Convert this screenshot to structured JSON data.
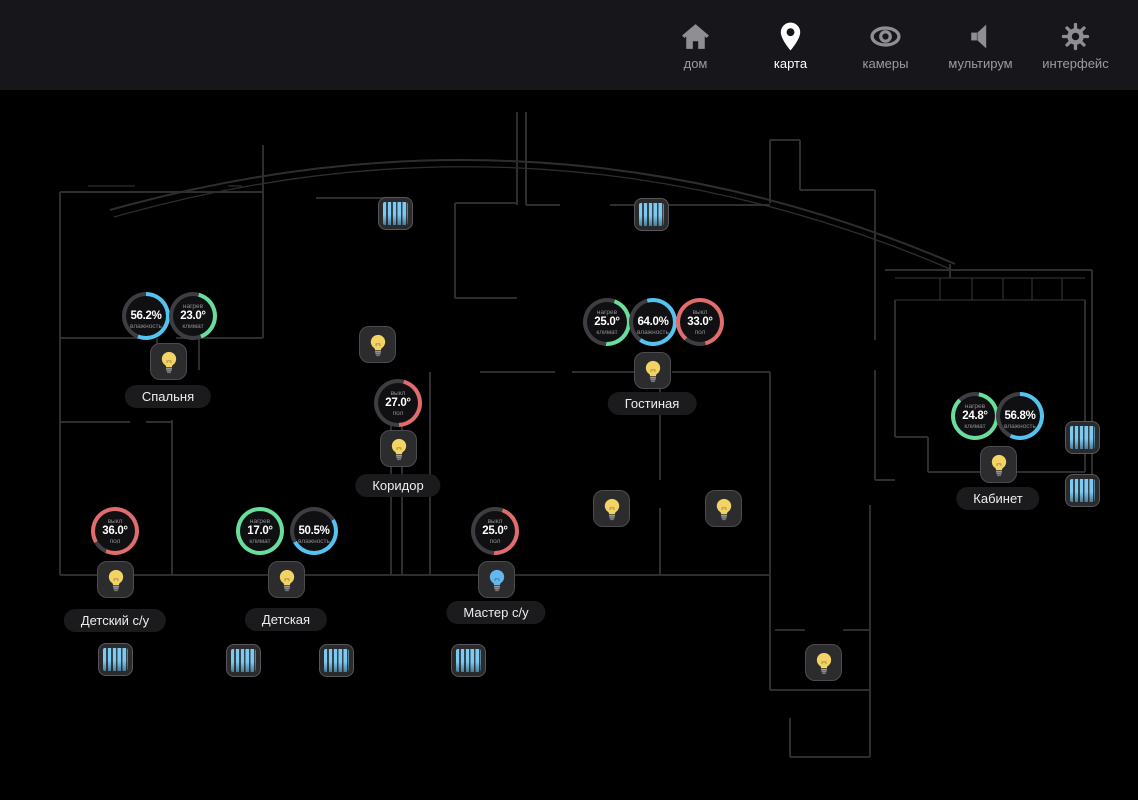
{
  "nav": {
    "items": [
      {
        "id": "home",
        "label": "дом",
        "icon": "home-icon",
        "active": false
      },
      {
        "id": "map",
        "label": "карта",
        "icon": "map-pin-icon",
        "active": true
      },
      {
        "id": "cameras",
        "label": "камеры",
        "icon": "eye-icon",
        "active": false
      },
      {
        "id": "multiroom",
        "label": "мультирум",
        "icon": "speaker-icon",
        "active": false
      },
      {
        "id": "interface",
        "label": "интерфейс",
        "icon": "gear-icon",
        "active": false
      }
    ]
  },
  "colors": {
    "humidity": "#55c3ef",
    "climate": "#69dd9c",
    "floor": "#e06c6c",
    "track": "#3e3e42",
    "bulb_yellow": "#f2d364",
    "bulb_blue": "#64b8f0",
    "nav_icon": "#8e8e93",
    "nav_icon_active": "#ffffff"
  },
  "map": {
    "gauges": [
      {
        "x": 146,
        "y": 226,
        "value": "56.2%",
        "top_label": "",
        "bottom_label": "влажность",
        "kind": "humidity",
        "fill_pct": 56,
        "rotate_deg": 0
      },
      {
        "x": 193,
        "y": 226,
        "value": "23.0°",
        "top_label": "нагрев",
        "bottom_label": "климат",
        "kind": "climate",
        "fill_pct": 40,
        "rotate_deg": 15
      },
      {
        "x": 607,
        "y": 232,
        "value": "25.0°",
        "top_label": "нагрев",
        "bottom_label": "климат",
        "kind": "climate",
        "fill_pct": 45,
        "rotate_deg": 20
      },
      {
        "x": 653,
        "y": 232,
        "value": "64.0%",
        "top_label": "",
        "bottom_label": "влажность",
        "kind": "humidity",
        "fill_pct": 64,
        "rotate_deg": -15
      },
      {
        "x": 700,
        "y": 232,
        "value": "33.0°",
        "top_label": "выкл",
        "bottom_label": "пол",
        "kind": "floor",
        "fill_pct": 85,
        "rotate_deg": -140
      },
      {
        "x": 398,
        "y": 313,
        "value": "27.0°",
        "top_label": "выкл",
        "bottom_label": "пол",
        "kind": "floor",
        "fill_pct": 45,
        "rotate_deg": 15
      },
      {
        "x": 975,
        "y": 326,
        "value": "24.8°",
        "top_label": "нагрев",
        "bottom_label": "климат",
        "kind": "climate",
        "fill_pct": 85,
        "rotate_deg": 10
      },
      {
        "x": 1020,
        "y": 326,
        "value": "56.8%",
        "top_label": "",
        "bottom_label": "влажность",
        "kind": "humidity",
        "fill_pct": 57,
        "rotate_deg": 0
      },
      {
        "x": 115,
        "y": 441,
        "value": "36.0°",
        "top_label": "выкл",
        "bottom_label": "пол",
        "kind": "floor",
        "fill_pct": 90,
        "rotate_deg": -120
      },
      {
        "x": 260,
        "y": 441,
        "value": "17.0°",
        "top_label": "нагрев",
        "bottom_label": "климат",
        "kind": "climate",
        "fill_pct": 100,
        "rotate_deg": 0
      },
      {
        "x": 314,
        "y": 441,
        "value": "50.5%",
        "top_label": "",
        "bottom_label": "влажность",
        "kind": "humidity",
        "fill_pct": 50,
        "rotate_deg": 60
      },
      {
        "x": 495,
        "y": 441,
        "value": "25.0°",
        "top_label": "выкл",
        "bottom_label": "пол",
        "kind": "floor",
        "fill_pct": 45,
        "rotate_deg": 20
      }
    ],
    "lights": [
      {
        "x": 168,
        "y": 271,
        "state": "yellow"
      },
      {
        "x": 377,
        "y": 254,
        "state": "yellow"
      },
      {
        "x": 652,
        "y": 280,
        "state": "yellow"
      },
      {
        "x": 398,
        "y": 358,
        "state": "yellow"
      },
      {
        "x": 998,
        "y": 374,
        "state": "yellow"
      },
      {
        "x": 611,
        "y": 418,
        "state": "yellow"
      },
      {
        "x": 723,
        "y": 418,
        "state": "yellow"
      },
      {
        "x": 115,
        "y": 489,
        "state": "yellow"
      },
      {
        "x": 286,
        "y": 489,
        "state": "yellow"
      },
      {
        "x": 496,
        "y": 489,
        "state": "blue"
      },
      {
        "x": 823,
        "y": 572,
        "state": "yellow"
      }
    ],
    "blinds": [
      {
        "x": 395,
        "y": 123
      },
      {
        "x": 651,
        "y": 124
      },
      {
        "x": 1082,
        "y": 347
      },
      {
        "x": 1082,
        "y": 400
      },
      {
        "x": 115,
        "y": 569
      },
      {
        "x": 243,
        "y": 570
      },
      {
        "x": 336,
        "y": 570
      },
      {
        "x": 468,
        "y": 570
      }
    ],
    "rooms": [
      {
        "x": 168,
        "y": 306,
        "name": "Спальня"
      },
      {
        "x": 652,
        "y": 313,
        "name": "Гостиная"
      },
      {
        "x": 398,
        "y": 395,
        "name": "Коридор"
      },
      {
        "x": 998,
        "y": 408,
        "name": "Кабинет"
      },
      {
        "x": 115,
        "y": 530,
        "name": "Детский с/у"
      },
      {
        "x": 286,
        "y": 529,
        "name": "Детская"
      },
      {
        "x": 496,
        "y": 522,
        "name": "Мастер с/у"
      }
    ]
  }
}
